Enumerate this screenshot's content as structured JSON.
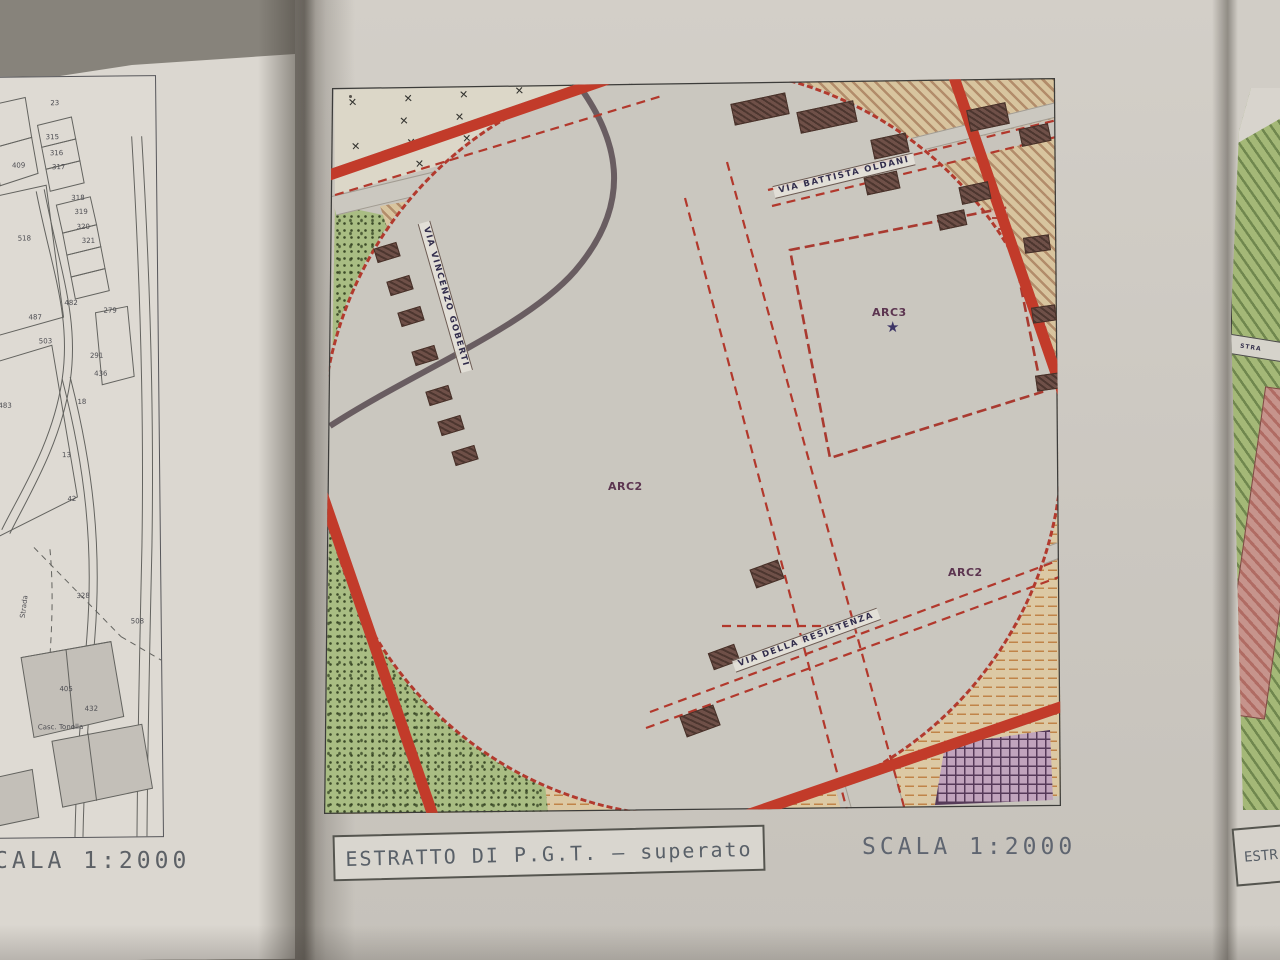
{
  "page": {
    "left_caption": "CALA 1:2000",
    "center_caption": "ESTRATTO DI P.G.T. – superato",
    "center_scale": "SCALA 1:2000",
    "right_caption_partial": "ESTR"
  },
  "left_map": {
    "labels": [
      {
        "label": "23",
        "x": 65,
        "y": 22
      },
      {
        "label": "315",
        "x": 60,
        "y": 56
      },
      {
        "label": "316",
        "x": 64,
        "y": 72
      },
      {
        "label": "317",
        "x": 66,
        "y": 86
      },
      {
        "label": "409",
        "x": 26,
        "y": 84
      },
      {
        "label": "318",
        "x": 85,
        "y": 117
      },
      {
        "label": "319",
        "x": 88,
        "y": 131
      },
      {
        "label": "320",
        "x": 90,
        "y": 146
      },
      {
        "label": "321",
        "x": 95,
        "y": 160
      },
      {
        "label": "518",
        "x": 31,
        "y": 157
      },
      {
        "label": "482",
        "x": 77,
        "y": 222
      },
      {
        "label": "279",
        "x": 116,
        "y": 230
      },
      {
        "label": "487",
        "x": 41,
        "y": 236
      },
      {
        "label": "503",
        "x": 51,
        "y": 260
      },
      {
        "label": "291",
        "x": 102,
        "y": 275
      },
      {
        "label": "436",
        "x": 106,
        "y": 293
      },
      {
        "label": "483",
        "x": 10,
        "y": 324
      },
      {
        "label": "18",
        "x": 89,
        "y": 321
      },
      {
        "label": "13",
        "x": 73,
        "y": 374
      },
      {
        "label": "42",
        "x": 78,
        "y": 418
      },
      {
        "label": "328",
        "x": 86,
        "y": 515
      },
      {
        "label": "508",
        "x": 140,
        "y": 541
      },
      {
        "label": "405",
        "x": 68,
        "y": 608
      },
      {
        "label": "432",
        "x": 93,
        "y": 628
      },
      {
        "label": "Strada",
        "x": 28,
        "y": 540,
        "rotate": -82
      },
      {
        "label": "Casc. Tonella",
        "x": 46,
        "y": 646
      }
    ]
  },
  "center_map": {
    "zone_labels": [
      {
        "label": "ARC2",
        "x": 288,
        "y": 414
      },
      {
        "label": "ARC3",
        "x": 552,
        "y": 240
      },
      {
        "label": "ARC2",
        "x": 628,
        "y": 500
      }
    ],
    "street_labels": [
      {
        "label": "VIA VINCENZO GOBERTI",
        "x": 104,
        "y": 150,
        "rotate": 74
      },
      {
        "label": "VIA BATTISTA OLDANI",
        "x": 454,
        "y": 120,
        "rotate": -13.5
      },
      {
        "label": "VIA DELLA RESISTENZA",
        "x": 414,
        "y": 594,
        "rotate": -20
      }
    ],
    "star_symbol": "★"
  },
  "right_map": {
    "street_label_partial": "STRA"
  }
}
